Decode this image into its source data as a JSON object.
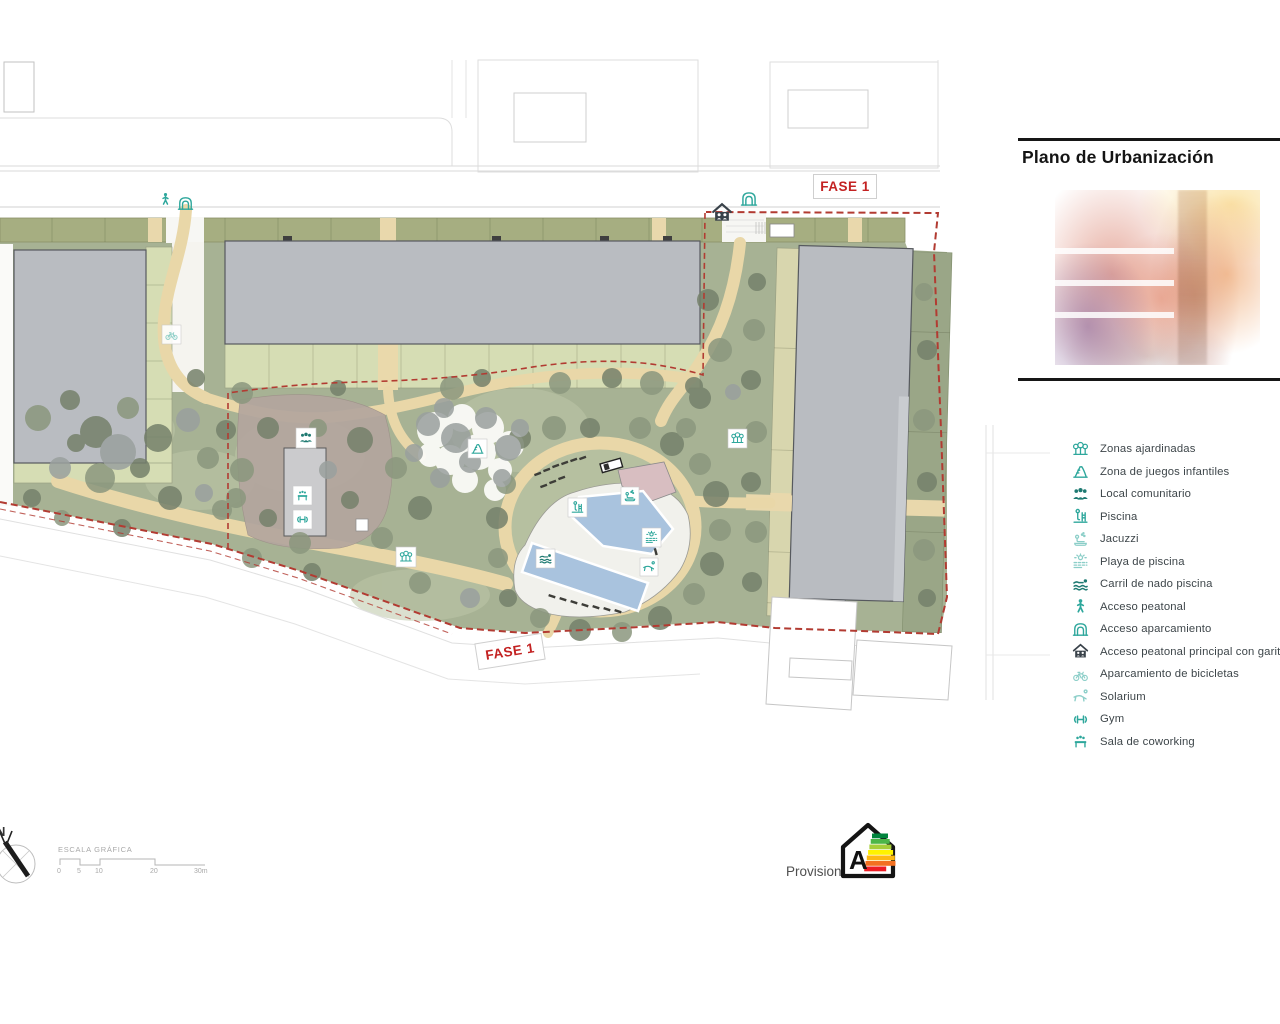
{
  "title_block": {
    "title": "Plano de Urbanización"
  },
  "phase_labels": {
    "top": "FASE 1",
    "bottom": "FASE 1"
  },
  "legend": {
    "items": [
      {
        "icon": "trees-icon",
        "label": "Zonas ajardinadas"
      },
      {
        "icon": "playground-icon",
        "label": "Zona de juegos infantiles"
      },
      {
        "icon": "community-icon",
        "label": "Local comunitario"
      },
      {
        "icon": "pool-ladder-icon",
        "label": "Piscina"
      },
      {
        "icon": "jacuzzi-icon",
        "label": "Jacuzzi"
      },
      {
        "icon": "pool-beach-icon",
        "label": "Playa de piscina"
      },
      {
        "icon": "swim-lane-icon",
        "label": "Carril de nado piscina"
      },
      {
        "icon": "pedestrian-icon",
        "label": "Acceso peatonal"
      },
      {
        "icon": "parking-access-icon",
        "label": "Acceso aparcamiento"
      },
      {
        "icon": "gatehouse-icon",
        "label": "Acceso peatonal principal con garita de"
      },
      {
        "icon": "bicycle-icon",
        "label": "Aparcamiento de bicicletas"
      },
      {
        "icon": "solarium-icon",
        "label": "Solarium"
      },
      {
        "icon": "gym-icon",
        "label": "Gym"
      },
      {
        "icon": "coworking-icon",
        "label": "Sala de coworking"
      }
    ]
  },
  "scale_bar": {
    "label": "ESCALA GRÁFICA",
    "ticks": [
      "0",
      "5",
      "10",
      "20",
      "30m"
    ]
  },
  "compass": {
    "north_label": "N"
  },
  "energy_badge": {
    "rating": "A",
    "caption": "Provisional",
    "bar_colors": [
      "#00843d",
      "#4cb648",
      "#a6ce39",
      "#fff200",
      "#fdb913",
      "#f37021",
      "#ed1c24"
    ]
  },
  "map": {
    "badges": [
      {
        "icon": "pedestrian-icon",
        "x": 160,
        "y": 194
      },
      {
        "icon": "parking-access-icon",
        "x": 180,
        "y": 196
      },
      {
        "icon": "gatehouse-icon",
        "x": 712,
        "y": 203
      },
      {
        "icon": "parking-access-icon",
        "x": 742,
        "y": 191
      },
      {
        "icon": "bicycle-icon",
        "x": 163,
        "y": 326
      },
      {
        "icon": "community-icon",
        "x": 297,
        "y": 429
      },
      {
        "icon": "coworking-icon",
        "x": 294,
        "y": 487
      },
      {
        "icon": "gym-icon",
        "x": 294,
        "y": 511
      },
      {
        "icon": "playground-icon",
        "x": 469,
        "y": 440
      },
      {
        "icon": "trees-icon",
        "x": 397,
        "y": 548
      },
      {
        "icon": "trees-icon",
        "x": 729,
        "y": 430
      },
      {
        "icon": "pool-ladder-icon",
        "x": 569,
        "y": 499
      },
      {
        "icon": "jacuzzi-icon",
        "x": 622,
        "y": 488
      },
      {
        "icon": "pool-beach-icon",
        "x": 643,
        "y": 529
      },
      {
        "icon": "solarium-icon",
        "x": 641,
        "y": 559
      },
      {
        "icon": "swim-lane-icon",
        "x": 537,
        "y": 550
      }
    ]
  },
  "colors": {
    "accent_teal": "#2ea79c",
    "accent_teal_dark": "#1f7a72",
    "icon_ink": "#39424a",
    "boundary_red": "#b23b32",
    "phase_label_red": "#c32222",
    "building_gray": "#b9bcc1",
    "garden_green": "#a7b294",
    "band_olive": "#a6ae81",
    "band_light": "#d6ddb4",
    "band_khaki": "#d8d6ae",
    "path_tan": "#e9d7a8",
    "pool_blue": "#a9c3de",
    "deck_white": "#f1f1ec",
    "paving_brown": "#b3a69e"
  }
}
